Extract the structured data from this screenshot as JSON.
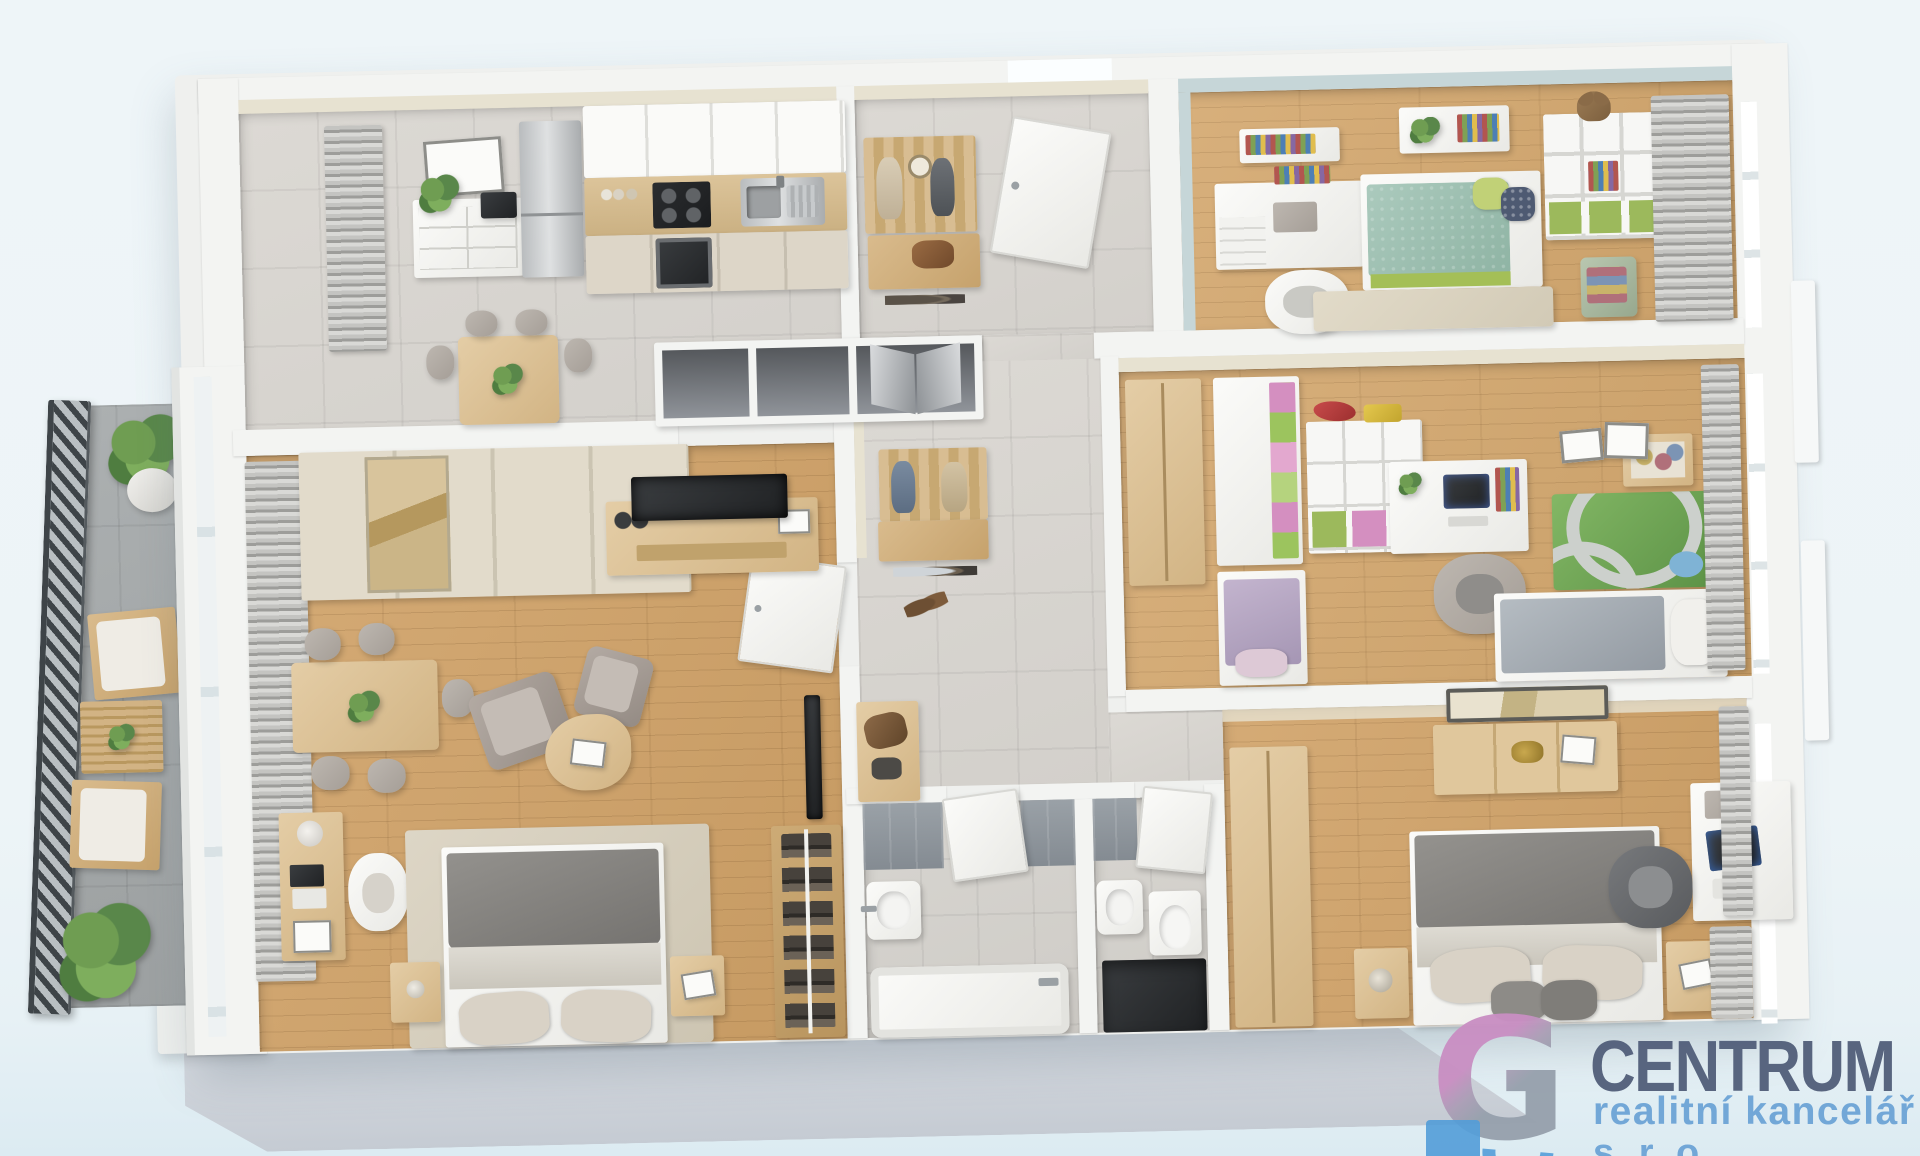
{
  "watermark": {
    "company": "CENTRUM",
    "tagline": "realitní kancelář",
    "suffix": "s.r.o.",
    "colors": {
      "company_text": "#53607b",
      "tagline_text": "#6ea5d6",
      "icon_pink": "#c98fc3",
      "icon_gray": "#97a1ad",
      "icon_blue": "#4f9bd8"
    }
  },
  "scene": {
    "type": "3d-floor-plan-render-top-view",
    "rooms": [
      "kitchen-dining",
      "entry-hall",
      "children-bedroom-1",
      "children-bedroom-2",
      "hallway",
      "living-room-with-bed",
      "bathroom",
      "wc",
      "master-bedroom",
      "balcony"
    ]
  },
  "palette": {
    "background": "#edf4f7",
    "wall": "#f1f2f0",
    "wall_beige": "#e7e2d1",
    "wall_blue": "#c6d6d8",
    "floor_tile": "#d8d5d0",
    "floor_wood": "#cda46f",
    "balcony_floor": "#a4a8a9",
    "railing": "#3e4448",
    "facade": "#ccd2d9"
  }
}
